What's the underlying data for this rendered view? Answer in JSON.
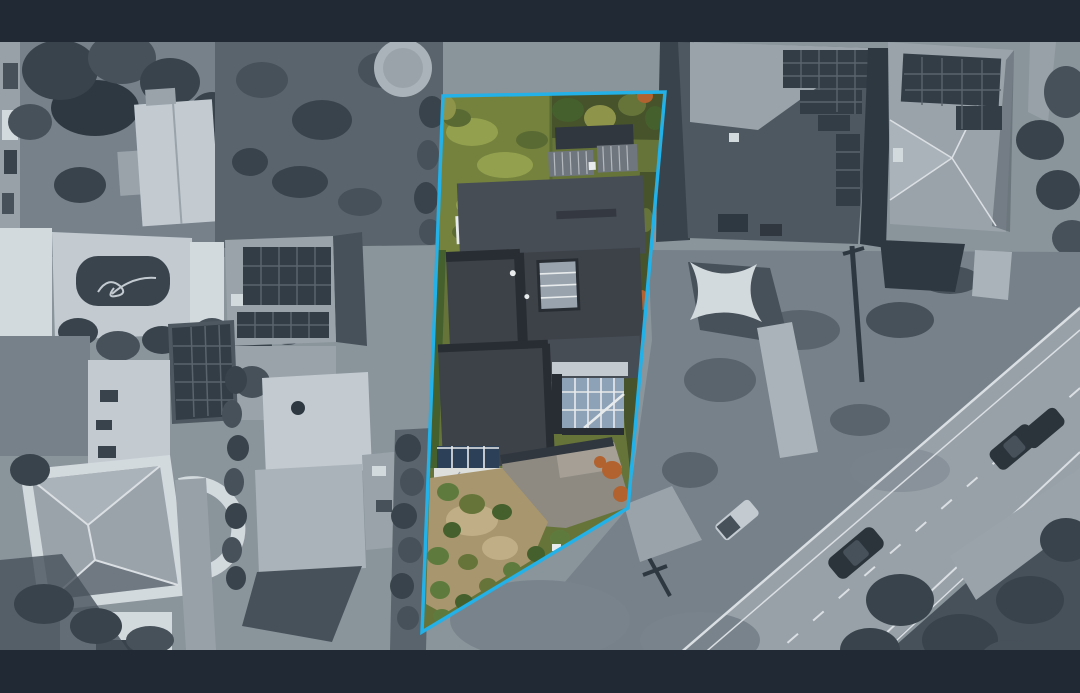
{
  "meta": {
    "type": "aerial-property-photograph",
    "description": "Top-down drone photo of a residential lot outlined in cyan; the lot interior is in full colour (green lawn, charcoal roof, tan garden, grey driveway) while the surrounding neighbourhood (houses with solar panels, swimming pool, hip-roof house, diagonal road with cars) is desaturated blue-grey. Dark letterbox bands run across the top and bottom."
  },
  "canvas": {
    "width": 1080,
    "height": 693
  },
  "letterbox": {
    "top_height": 42,
    "photo_bottom": 650,
    "color": "#212935"
  },
  "boundary": {
    "color": "#23b1e7",
    "stroke_width": 3.5,
    "points_str": "443,96 665,92 628,508 422,632"
  },
  "palette": {
    "band": "#212935",
    "base": "#8a949b",
    "ground": "#77818a",
    "grounddark": "#5a646c",
    "road": "#98a1a8",
    "roaddark": "#79838b",
    "pathlight": "#aab3b9",
    "white": "#d3dade",
    "offwhite": "#c3cbd1",
    "roofmid": "#9aa3aa",
    "roofdark": "#4e5860",
    "treedark": "#39434b",
    "treemid": "#47515a",
    "shadow": "#2e3841",
    "solar": "#333d46",
    "solarline": "#5a646c",
    "cardark": "#2b333b",
    "linewhite": "#dadfe3",
    "pool": "#3a444d",
    "lawn": "#74823e",
    "lawnlight": "#93a04e",
    "lawndark": "#5a6a33",
    "foliage": "#46532b",
    "foliagelight": "#66743a",
    "yellowtree": "#8e9449",
    "roofA": "#3d4249",
    "roofB": "#474d55",
    "roofseam": "#282d33",
    "ribpanel": "#70767d",
    "riblight": "#b3b9bf",
    "skylight": "#99a3ad",
    "glass": "#8da2b7",
    "framewhite": "#e8ebec",
    "glassdark": "#2c4158",
    "deck": "#dddfdc",
    "drive": "#8e8a82",
    "drivelight": "#a59f96",
    "dirt": "#a8976e",
    "dirtlight": "#c0af86",
    "shrub": "#5e7b3d",
    "shrubdark": "#45602c",
    "orange": "#b2622e",
    "spa": "#3f74ad",
    "spalight": "#6c97c6",
    "garagegray": "#31373e",
    "boundary": "#23b1e7"
  }
}
